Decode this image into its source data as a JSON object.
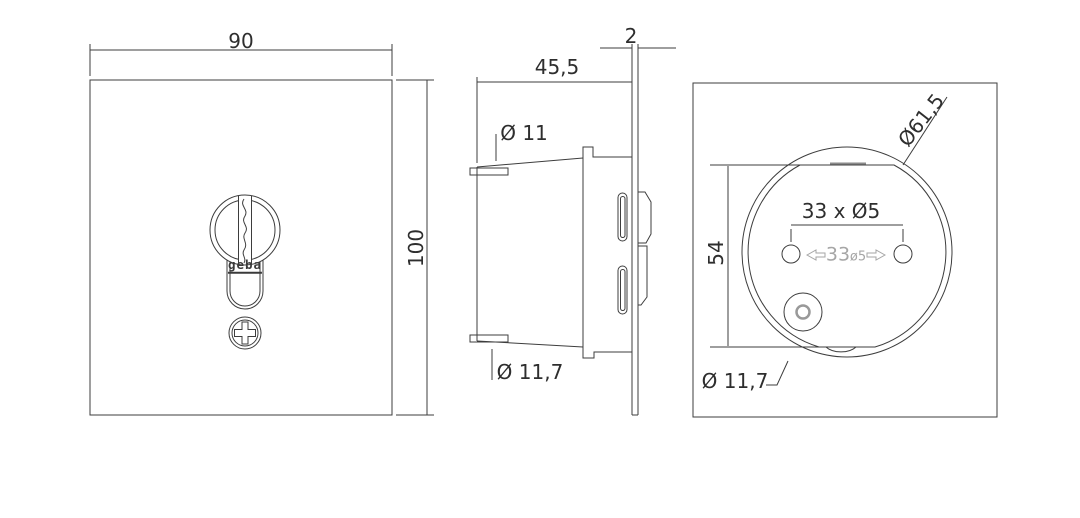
{
  "drawing": {
    "title": "geba key switch dimensional drawing",
    "front_view": {
      "width_label": "90",
      "height_label": "100",
      "logo": "geba"
    },
    "side_view": {
      "depth_label": "45,5",
      "plate_thickness_label": "2",
      "top_knockout_label": "Ø 11",
      "bottom_knockout_label": "Ø 11,7"
    },
    "back_view": {
      "housing_diameter_label": "Ø61,5",
      "flat_height_label": "54",
      "hole_spacing_label": "33 x Ø5",
      "cable_entry_label": "Ø 11,7",
      "embossed_value": "33",
      "embossed_dia": "ø5"
    },
    "colors": {
      "line": "#3d3d3d",
      "emboss": "#a6a6a6",
      "background": "#ffffff"
    }
  }
}
